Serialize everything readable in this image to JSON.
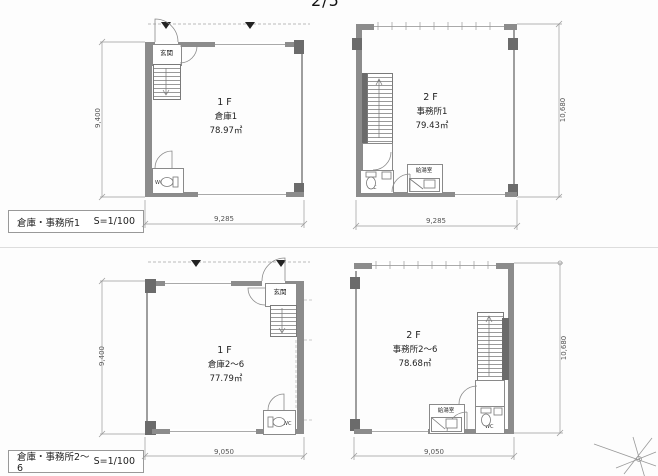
{
  "page_number": "2/5",
  "colors": {
    "wall": "#8c8c8c",
    "wall_dark": "#6b6b6b",
    "line": "#8a8a8a",
    "dim_text": "#555555",
    "text": "#222222"
  },
  "icons": {
    "north_symbol": "compass-star-icon",
    "canopy_marker": "triangle-down-icon"
  },
  "plans": [
    {
      "floor": "1F",
      "name": "倉庫1",
      "area": "78.97㎡",
      "dim_vertical": "9,400",
      "dim_horizontal": "9,285",
      "entrance_label": "玄関",
      "wc_label": "WC"
    },
    {
      "floor": "2F",
      "name": "事務所1",
      "area": "79.43㎡",
      "dim_vertical": "10,680",
      "dim_horizontal": "9,285",
      "wc_label": "WC",
      "kitchen_label": "給湯室"
    },
    {
      "floor": "1F",
      "name": "倉庫2～6",
      "area": "77.79㎡",
      "dim_vertical": "9,400",
      "dim_horizontal": "9,050",
      "entrance_label": "玄関",
      "wc_label": "WC"
    },
    {
      "floor": "2F",
      "name": "事務所2～6",
      "area": "78.68㎡",
      "dim_vertical": "10,680",
      "dim_horizontal": "9,050",
      "wc_label": "WC",
      "kitchen_label": "給湯室"
    }
  ],
  "captions": [
    {
      "title": "倉庫・事務所1",
      "scale": "S=1/100"
    },
    {
      "title": "倉庫・事務所2～6",
      "scale": "S=1/100"
    }
  ]
}
